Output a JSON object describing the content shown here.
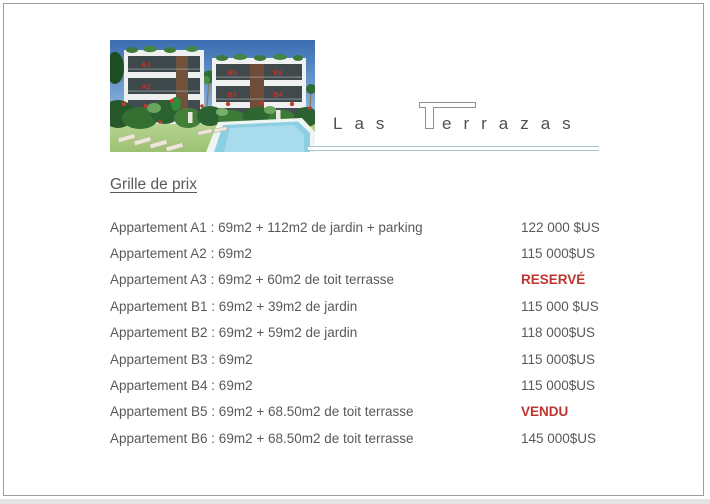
{
  "window": {
    "page_background": "#ffffff",
    "page_border_color": "#9e9e9e",
    "app_background_strip": "#e4e4e4"
  },
  "logo": {
    "word_start": "Las",
    "big_letter": "T",
    "word_rest": "errazas",
    "text_color": "#4f4f4f",
    "rule_color": "#a9c7cd"
  },
  "photo": {
    "description": "3D render of Las Terrazas apartment buildings with garden, sun loungers and pool",
    "unit_labels": [
      "A1",
      "A2",
      "A3",
      "B5",
      "B6",
      "B3",
      "B4",
      "B1",
      "B2"
    ],
    "unit_label_color": "#cf2b26",
    "sky_color": "#3a6db1",
    "pool_color": "#8ccfe2"
  },
  "document": {
    "heading": "Grille de prix",
    "text_color": "#595959",
    "status_red_color": "#bf3430",
    "rows": [
      {
        "label": "Appartement A1 : 69m2 + 112m2 de jardin + parking",
        "price": "122 000 $US",
        "red": false
      },
      {
        "label": "Appartement A2 : 69m2",
        "price": "115 000$US",
        "red": false
      },
      {
        "label": "Appartement A3 : 69m2 + 60m2 de toit terrasse",
        "price": "RESERVÉ",
        "red": true
      },
      {
        "label": "Appartement B1 : 69m2 + 39m2 de jardin",
        "price": "115 000 $US",
        "red": false
      },
      {
        "label": "Appartement B2 : 69m2 + 59m2 de jardin",
        "price": "118 000$US",
        "red": false
      },
      {
        "label": "Appartement B3 : 69m2",
        "price": "115 000$US",
        "red": false
      },
      {
        "label": "Appartement B4 : 69m2",
        "price": "115 000$US",
        "red": false
      },
      {
        "label": "Appartement B5 : 69m2 + 68.50m2 de toit terrasse",
        "price": "VENDU",
        "red": true
      },
      {
        "label": "Appartement B6 : 69m2 + 68.50m2 de toit terrasse",
        "price": "145 000$US",
        "red": false
      }
    ]
  }
}
